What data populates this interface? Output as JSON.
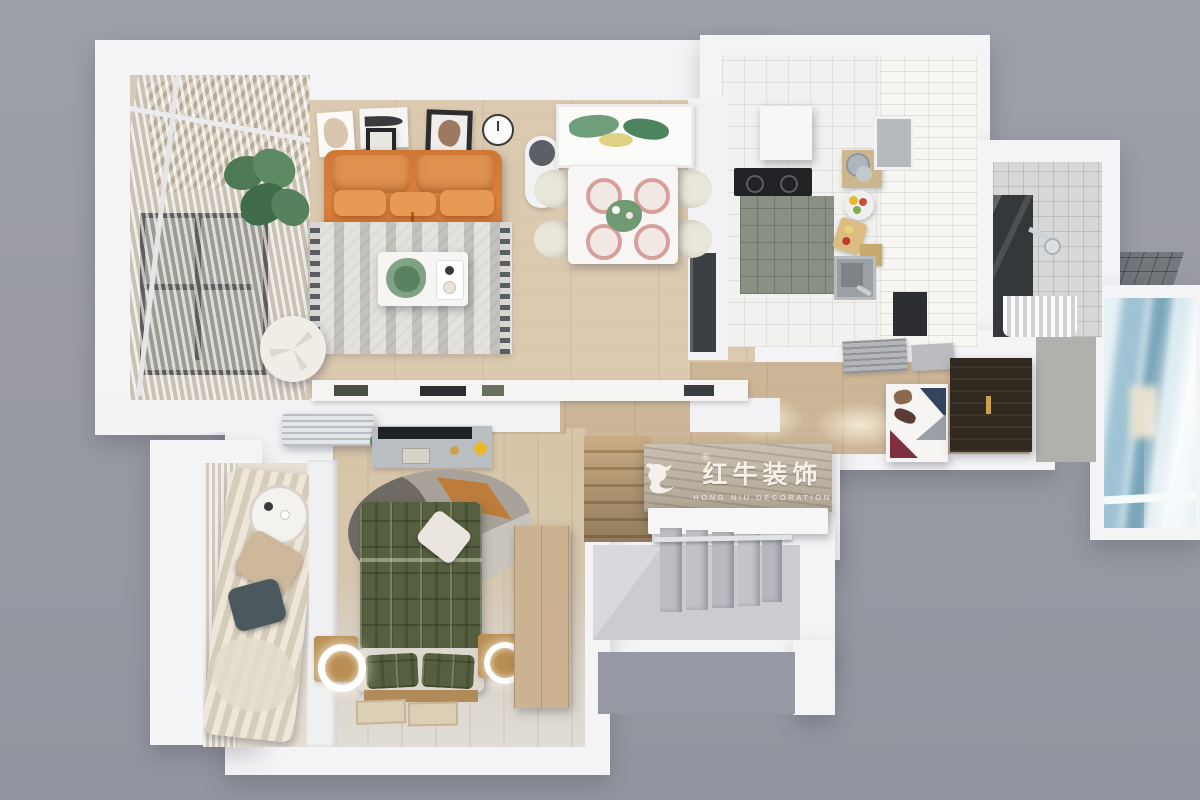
{
  "watermark": {
    "brand_cn": "红牛装饰",
    "brand_en": "HONG NIU DECORATION",
    "registered_mark": "®",
    "logo_icon": "hongniu-bull-icon"
  },
  "scene": {
    "type": "3d-top-down-floor-plan-render",
    "rooms": [
      "living-room",
      "dining-area",
      "kitchen",
      "bathroom",
      "entry-hall",
      "bedroom",
      "living-balcony",
      "bedroom-balcony",
      "stairwell",
      "window-bay"
    ]
  },
  "colors": {
    "background": "#9a9ba4",
    "walls": "#f4f4f6",
    "wood_floor": "#dccab0",
    "hall_wood": "#cdb697",
    "sofa_orange": "#d9813f",
    "bed_green": "#566040",
    "banner_wood": "#c3b8a7",
    "logo_text": "#f4f1ea",
    "entry_door": "#31281f",
    "window_view_blue": "#8fb7c9"
  }
}
